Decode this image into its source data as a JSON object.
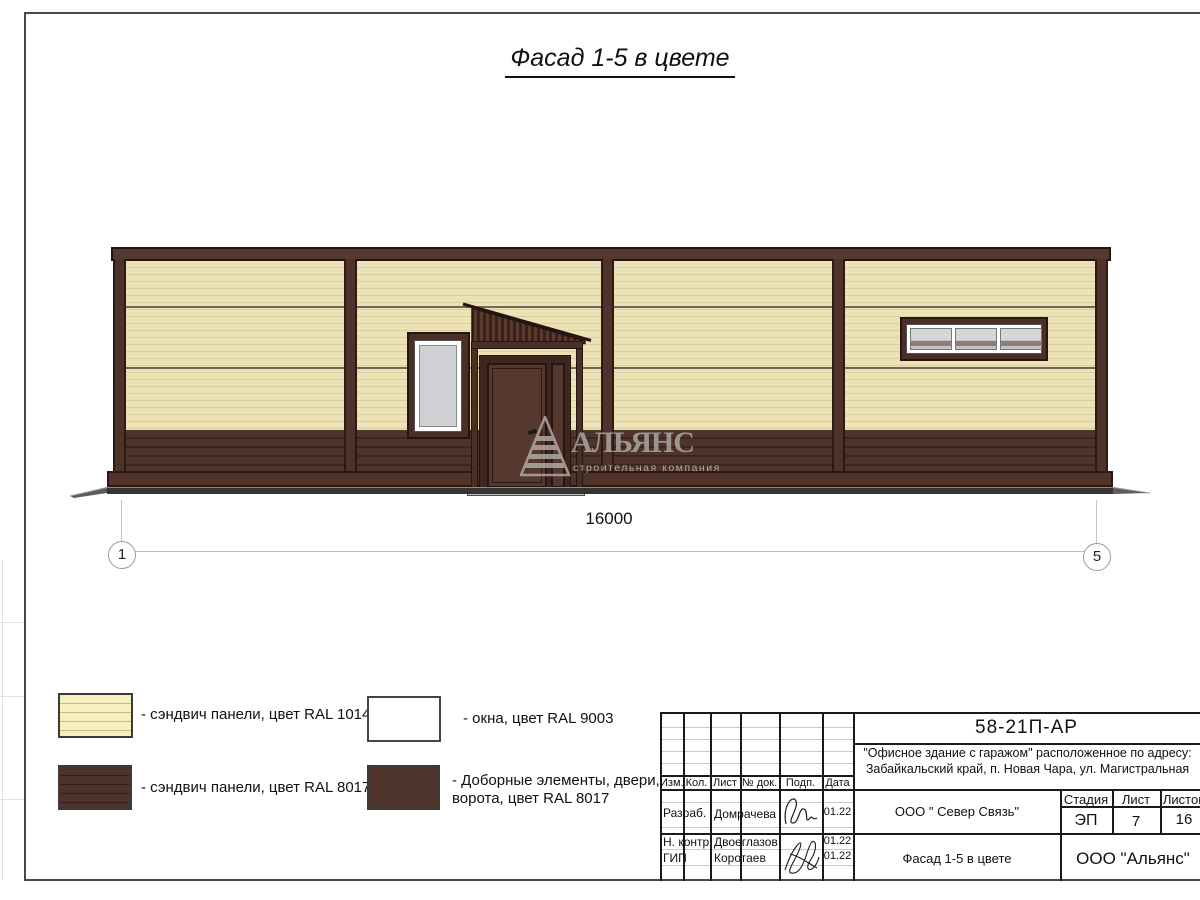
{
  "sheet_title": "Фасад 1-5 в цвете",
  "elevation": {
    "dimension_total": "16000",
    "grid_marks": {
      "left": "1",
      "right": "5"
    },
    "watermark": {
      "title": "АЛЬЯНС",
      "subtitle": "строительная компания"
    }
  },
  "colors": {
    "panel_ral1014": "#e7ddae",
    "panel_ral8017": "#4f332b",
    "window_ral9003": "#ffffff",
    "glass": "#cfd0d3",
    "ground": "#353535",
    "legend_ral1014": "#f7f0bd"
  },
  "legend": {
    "items": [
      {
        "label": "- сэндвич панели, цвет RAL 1014"
      },
      {
        "label": "- сэндвич панели, цвет RAL 8017"
      },
      {
        "label": "- окна, цвет RAL 9003"
      },
      {
        "label": "- Доборные элементы, двери,",
        "label2": "ворота, цвет RAL 8017"
      }
    ]
  },
  "titleblock": {
    "doc_number": "58-21П-АР",
    "project_address_line1": "\"Офисное здание с гаражом\" расположенное по адресу:",
    "project_address_line2": "Забайкальский край, п. Новая Чара, ул. Магистральная",
    "header_cells": {
      "izm": "Изм.",
      "kol": "Кол.",
      "list": "Лист",
      "doc": "№ док.",
      "podp": "Подп.",
      "data": "Дата"
    },
    "signature_rows": [
      {
        "role": "Разраб.",
        "name": "Домрачева",
        "date": "01.22"
      },
      {
        "role": "Н. контр.",
        "name": "Двоеглазов",
        "date": "01.22"
      },
      {
        "role": "ГИП",
        "name": "Коротаев",
        "date": "01.22"
      }
    ],
    "client": "ООО \" Север Связь\"",
    "stage": {
      "label": "Стадия",
      "value": "ЭП"
    },
    "sheet": {
      "label": "Лист",
      "value": "7"
    },
    "sheets_total": {
      "label": "Листов",
      "value": "16"
    },
    "drawing_title": "Фасад 1-5 в цвете",
    "company": "ООО \"Альянс\""
  }
}
